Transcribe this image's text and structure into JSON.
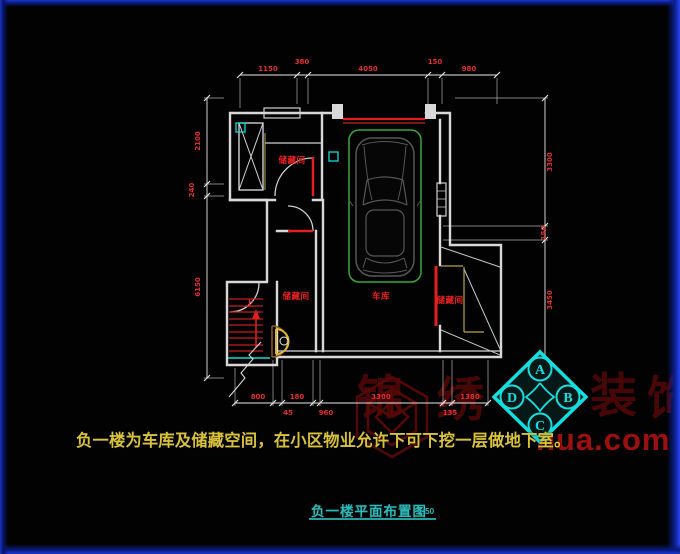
{
  "annotation": "负一楼为车库及储藏空间，在小区物业允许下可下挖一层做地下室。",
  "title": {
    "text": "负一楼平面布置图",
    "scale": "1:50"
  },
  "rooms": {
    "top_left": "储藏间",
    "mid_left": "储藏间",
    "garage": "车库",
    "right": "储藏间",
    "stairs_up": "上"
  },
  "dims": {
    "top": [
      "1150",
      "380",
      "4050",
      "150",
      "980"
    ],
    "left": [
      "2100",
      "240",
      "6150"
    ],
    "right": [
      "3300",
      "150",
      "3450"
    ],
    "bottom_upper": [
      "800",
      "180",
      "3300",
      "1380"
    ],
    "bottom_lower": [
      "45",
      "960",
      "135"
    ]
  },
  "watermark": {
    "brand": [
      "锦",
      "绣",
      "装",
      "饰"
    ],
    "url": "hua.com",
    "badge": {
      "top": "A",
      "right": "B",
      "bottom": "C",
      "left": "D"
    }
  },
  "colors": {
    "wall_line": "#d8d8d8",
    "dim_text": "#e03030",
    "accent_red": "#e02020",
    "car_green": "#37a637",
    "cad_cyan": "#17dede",
    "note_yellow": "#d8c23c",
    "watermark_dark_red": "#4c0808",
    "url_red": "#9c1010",
    "border_blue": "#1a38d8"
  }
}
